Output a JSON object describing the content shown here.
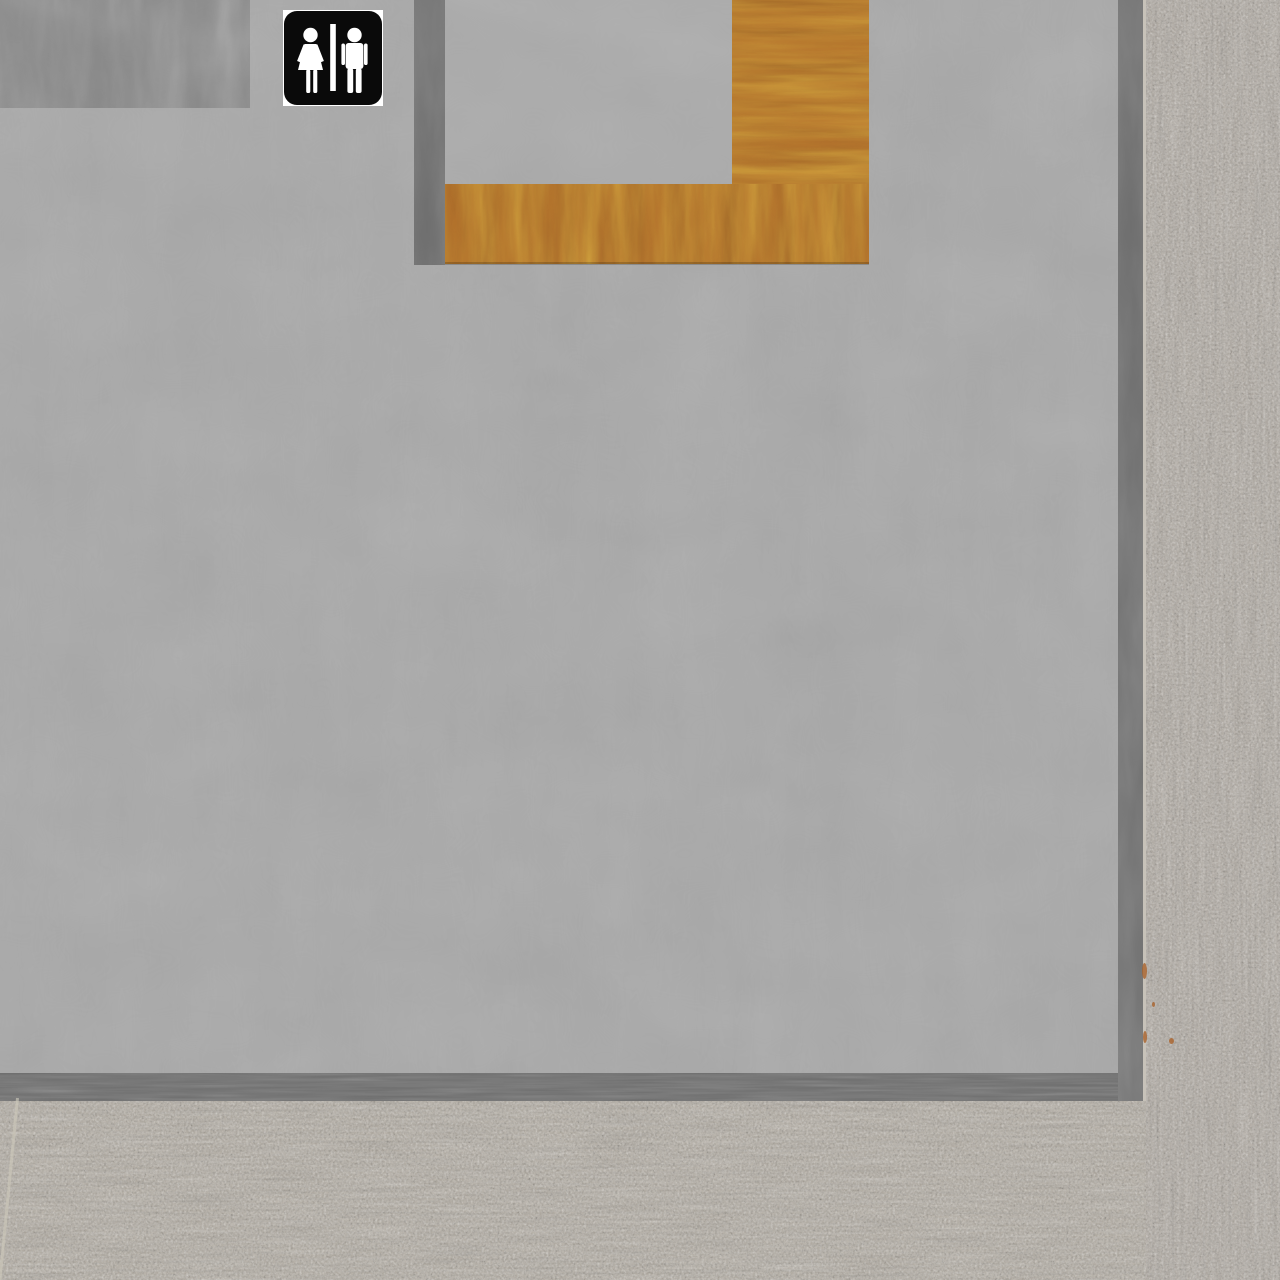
{
  "scene": {
    "type": "3d-game-environment",
    "label": "first-person view of a restroom entrance wall with unisex restroom sign, wood door frame, granite pillar and granite floor"
  },
  "colors": {
    "wall": "#a9a9a9",
    "inset_panel": "#ababab",
    "dark_panel": "#7d7d7d",
    "trim": "#6d6d6d",
    "wood": "#b5722b",
    "granite_pillar": "#b0a9a0",
    "granite_floor": "#b2aba0",
    "edge_highlight": "#d5cfc4",
    "floor_seam": "#cdc7ba",
    "rust": "#a9622a",
    "sign_plate": "#ffffff",
    "sign_bg": "#0a0a0a",
    "sign_fg": "#ffffff"
  },
  "sign": {
    "kind": "restroom-sign",
    "symbols": [
      "woman-pictogram",
      "divider-bar",
      "man-pictogram"
    ]
  },
  "regions": [
    {
      "name": "wall-plaster",
      "material": "gray plaster"
    },
    {
      "name": "wall-panel-dark",
      "material": "gray plywood panel"
    },
    {
      "name": "door-trim-left",
      "material": "dark gray wood trim"
    },
    {
      "name": "door-inset-panel",
      "material": "gray plaster"
    },
    {
      "name": "wood-frame-column",
      "material": "orange wood, horizontal grain"
    },
    {
      "name": "wood-frame-bar",
      "material": "orange wood, flame grain"
    },
    {
      "name": "wall-edge-right-trim",
      "material": "dark gray wood trim"
    },
    {
      "name": "wall-base-trim",
      "material": "dark gray wood trim"
    },
    {
      "name": "granite-pillar",
      "material": "speckled granite, vertical striations"
    },
    {
      "name": "granite-floor",
      "material": "speckled granite, horizontal striations"
    }
  ]
}
